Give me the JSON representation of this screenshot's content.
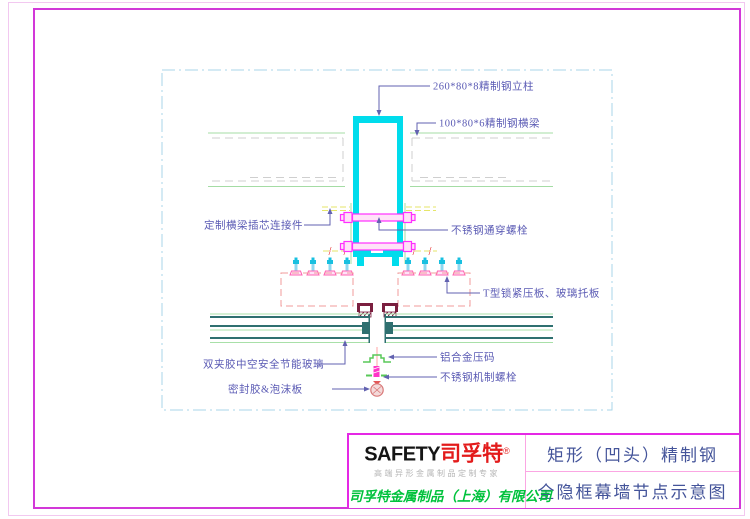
{
  "drawing": {
    "labels": {
      "column": "260*80*8精制钢立柱",
      "beam": "100*80*6精制钢横梁",
      "connector": "定制横梁插芯连接件",
      "through_bolt": "不锈钢通穿螺栓",
      "t_plate": "T型锁紧压板、玻璃托板",
      "glass": "双夹胶中空安全节能玻璃",
      "pressure_block": "铝合金压码",
      "machine_bolt": "不锈钢机制螺栓",
      "sealant": "密封胶&泡沫板"
    }
  },
  "title_block": {
    "brand_en": "SAFETY",
    "brand_cn": "司孚特",
    "registered": "®",
    "tagline": "高端异形金属制品定制专家",
    "company": "司孚特金属制品（上海）有限公司",
    "product_title": "矩形（凹头）精制钢",
    "drawing_title": "全隐框幕墙节点示意图"
  },
  "colors": {
    "sheet_border_outer": "#F2C8F0",
    "sheet_border_inner": "#D238D8",
    "title_block_border": "#E528E5",
    "title_block_divider": "#FBA6E3",
    "viewport_dash": "#A9D6E8",
    "steel_cyan": "#00DCEC",
    "bolt_magenta": "#FF30FF",
    "beam_green": "#A4DCA4",
    "label_blue": "#5A5AB4",
    "dashed_red": "#F29B9B",
    "glass_teal": "#2F7070",
    "clip_maroon": "#7B1F3F",
    "connector_yellow": "#E6E66A",
    "brand_red": "#E31B1B",
    "company_green": "#00C23C",
    "title_text_blue": "#44549A"
  }
}
